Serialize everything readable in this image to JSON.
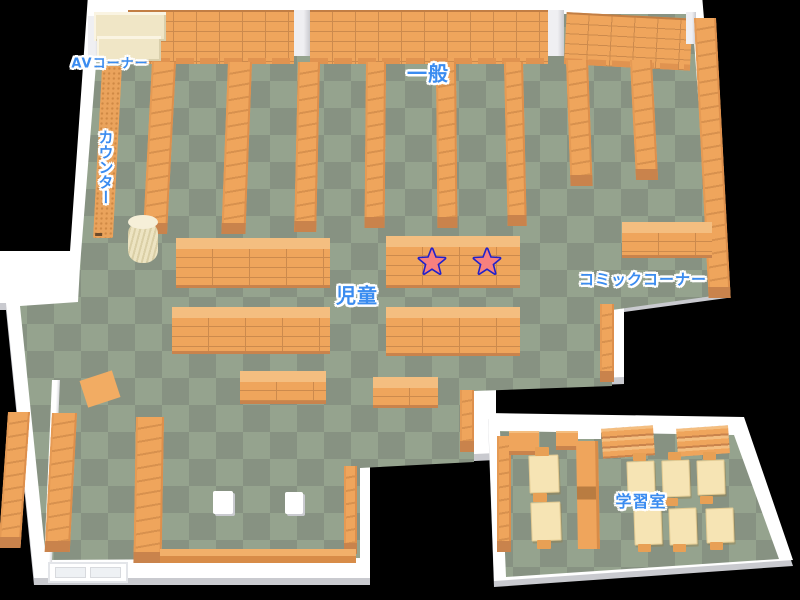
{
  "map": {
    "name": "Library floor map",
    "areas": {
      "av_corner": "AVコーナー",
      "counter": "カウンター",
      "general": "一般",
      "children": "児童",
      "comic_corner": "コミックコーナー",
      "study_room": "学習室"
    },
    "markers": [
      {
        "id": "star-1",
        "type": "star"
      },
      {
        "id": "star-2",
        "type": "star"
      }
    ],
    "colors": {
      "background": "#000000",
      "floor_light": "#95A38E",
      "floor_dark": "#879282",
      "wall_white": "#FFFFFF",
      "wall_shadow": "#C9CACF",
      "shelf_orange": "#EFA55C",
      "shelf_line": "#CC8A4D",
      "shelf_dark": "#C9834C",
      "shelf_top": "#F4BE80",
      "cream": "#F0E6C6",
      "desk_cream": "#F6E4B4",
      "label_blue": "#3B8CF0",
      "star_fill": "#F8807E",
      "star_outline": "#2121CB"
    }
  }
}
